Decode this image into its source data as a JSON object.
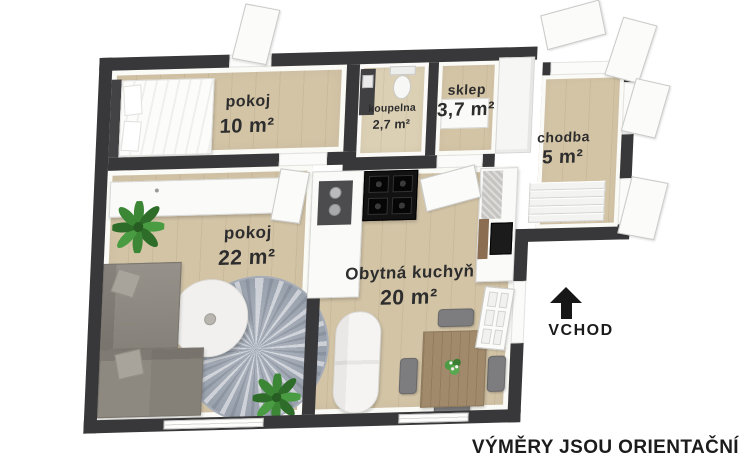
{
  "rooms": [
    {
      "id": "bedroom",
      "name": "pokoj",
      "area": "10 m²"
    },
    {
      "id": "bathroom",
      "name": "koupelna",
      "area": "2,7 m²"
    },
    {
      "id": "storage",
      "name": "sklep",
      "area": "3,7 m²"
    },
    {
      "id": "hallway",
      "name": "chodba",
      "area": "5 m²"
    },
    {
      "id": "living",
      "name": "pokoj",
      "area": "22 m²"
    },
    {
      "id": "kitchen",
      "name": "Obytná kuchyň",
      "area": "20 m²"
    }
  ],
  "entrance": {
    "label": "VCHOD",
    "icon": "arrow-up-icon"
  },
  "disclaimer": "VÝMĚRY JSOU ORIENTAČNÍ",
  "colors": {
    "wall": "#38383a",
    "floor_wood": "#d3c4a6",
    "floor_light": "#dbcfb4",
    "text": "#2d2d2d",
    "sofa_gray": "#8d8880",
    "plant_green": "#3c8736",
    "table_wood": "#a18a6b",
    "background": "#ffffff"
  }
}
